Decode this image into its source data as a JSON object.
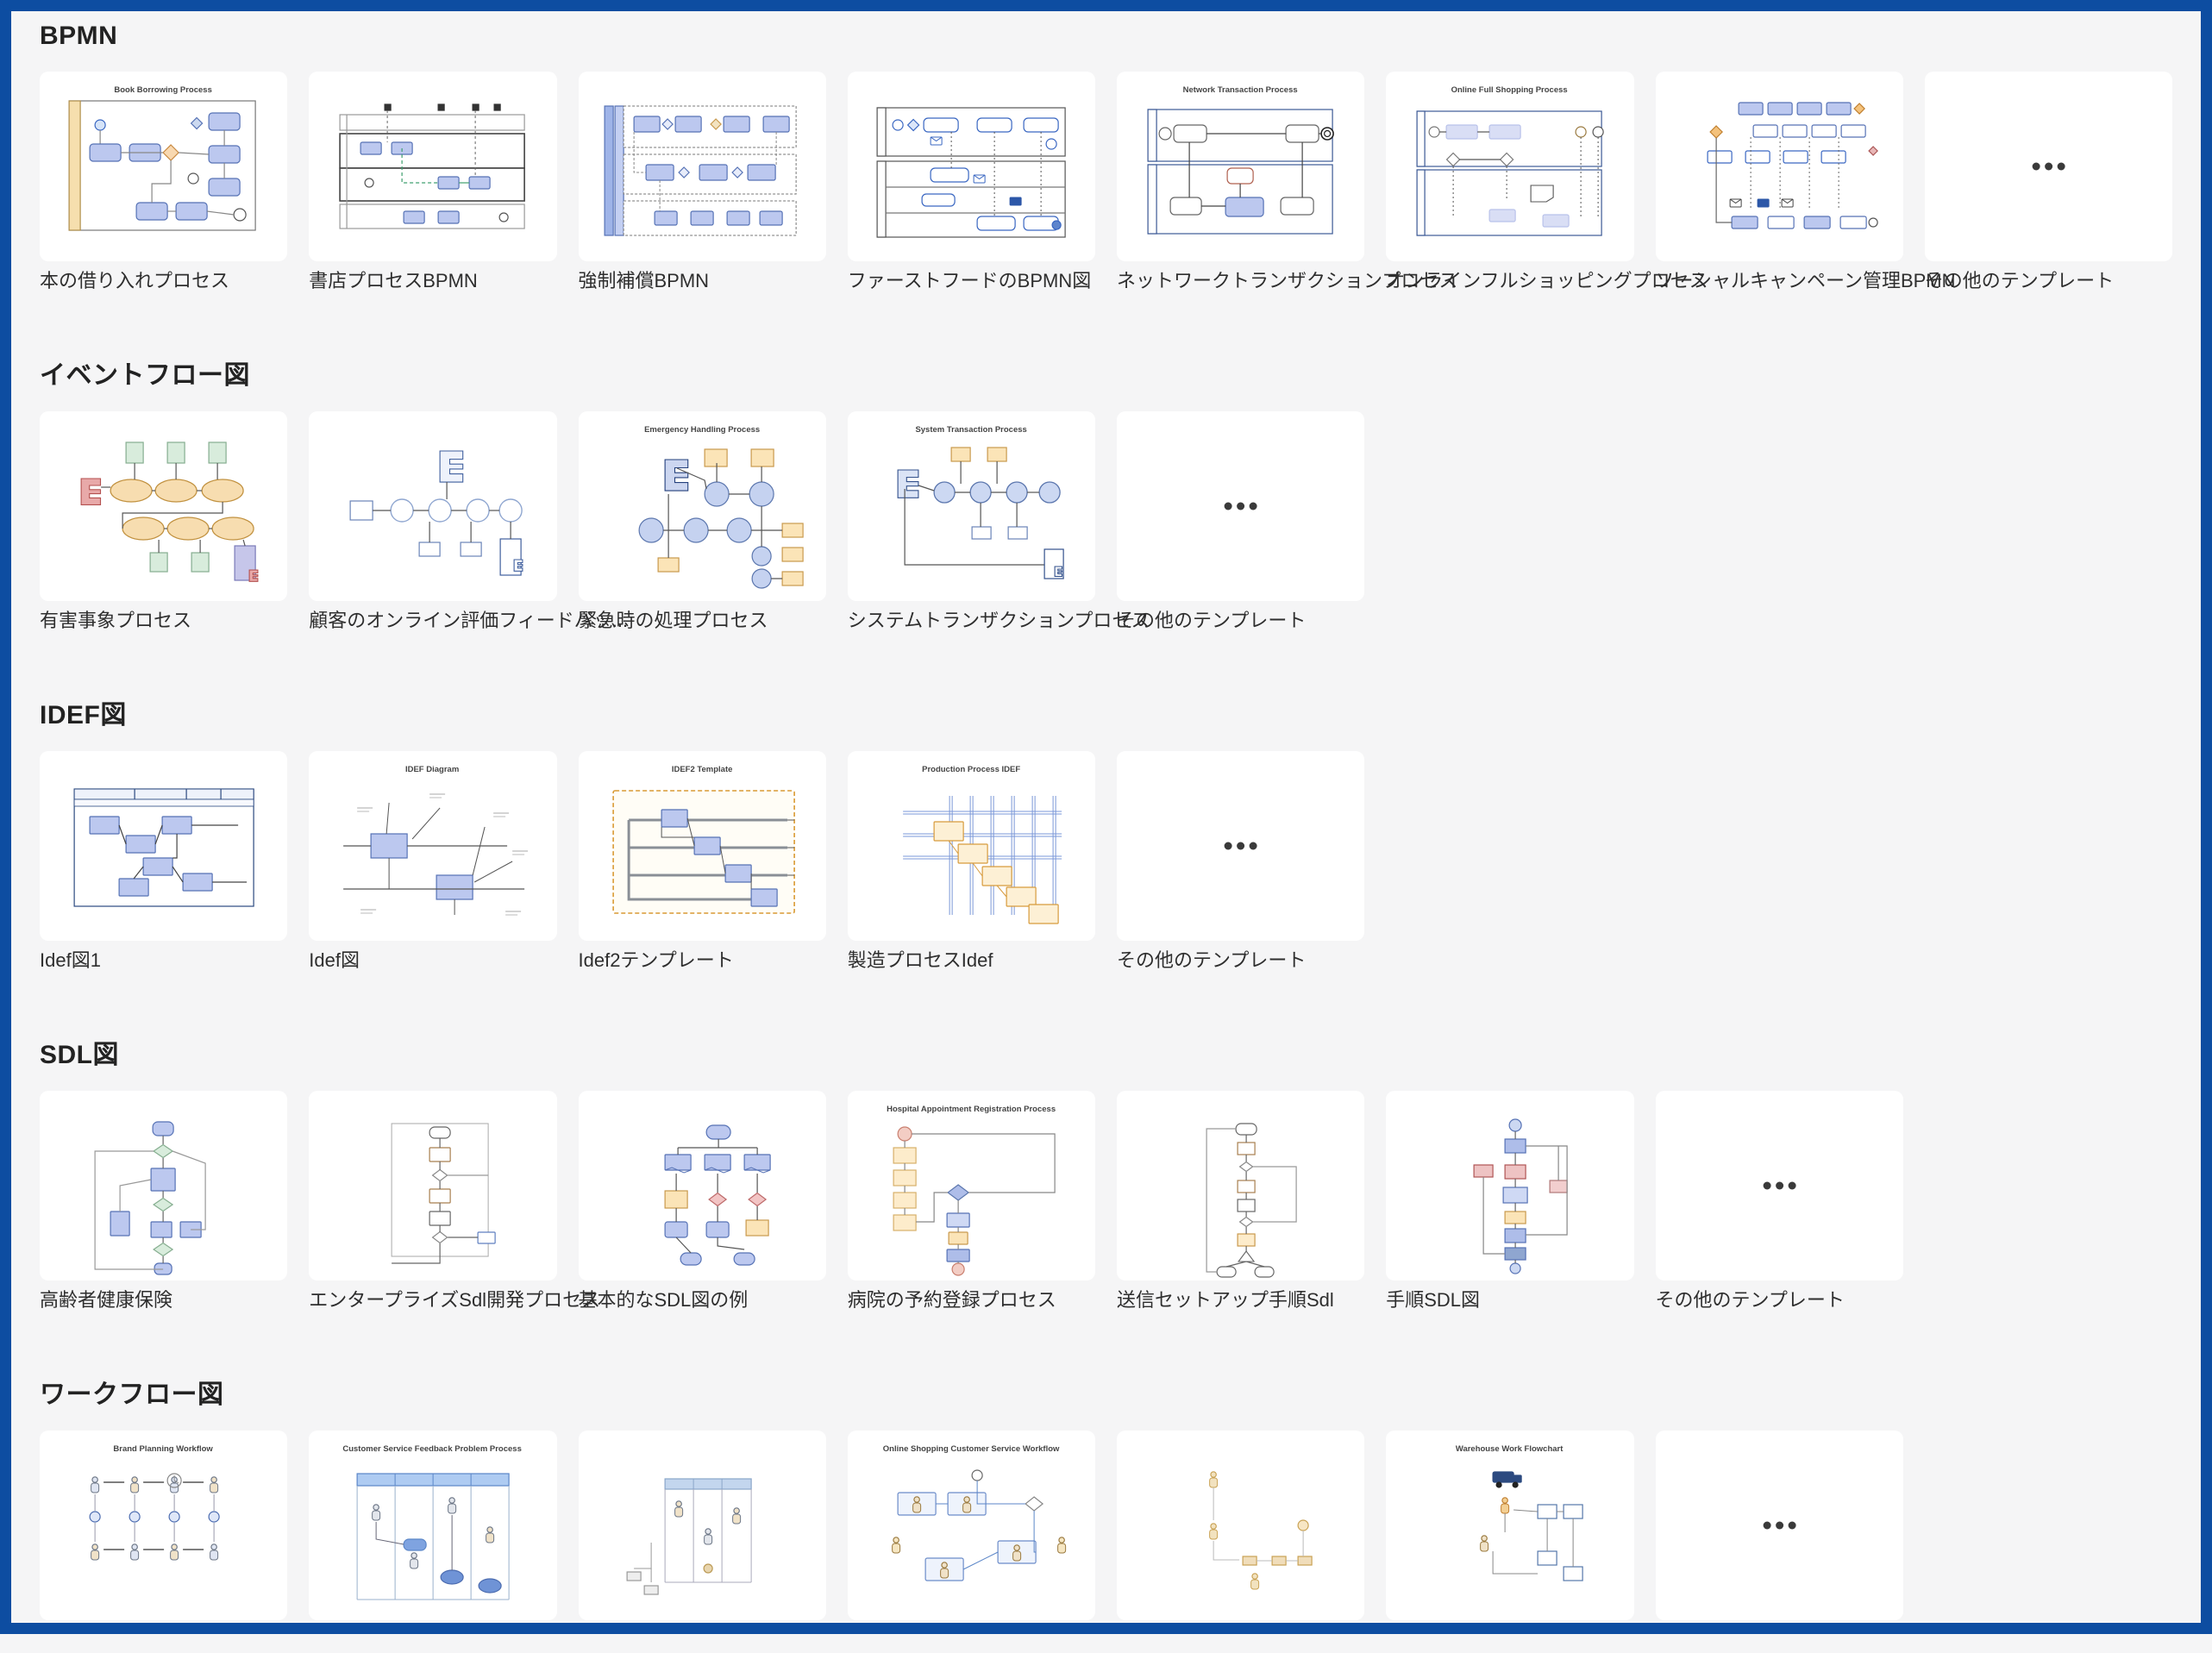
{
  "page": {
    "frame_color": "#0d4da1",
    "background_color": "#f5f5f6",
    "card_color": "#ffffff",
    "heading_color": "#222222",
    "label_color": "#2e2e2e",
    "ellipsis_color": "#3a3a3a"
  },
  "sections": [
    {
      "title": "BPMN",
      "cards": [
        {
          "label": "本の借り入れプロセス",
          "thumb_title": "Book Borrowing Process",
          "kind": "bpmn_library"
        },
        {
          "label": "書店プロセスBPMN",
          "kind": "bpmn_lanes_h"
        },
        {
          "label": "強制補償BPMN",
          "kind": "bpmn_lanes_blue"
        },
        {
          "label": "ファーストフードのBPMN図",
          "kind": "bpmn_pool"
        },
        {
          "label": "ネットワークトランザクションプロセス",
          "thumb_title": "Network Transaction Process",
          "kind": "bpmn_network"
        },
        {
          "label": "オンラインフルショッピングプロセス",
          "thumb_title": "Online Full Shopping Process",
          "kind": "bpmn_shopping"
        },
        {
          "label": "ソーシャルキャンペーン管理BPMN",
          "kind": "bpmn_social"
        },
        {
          "label": "その他のテンプレート",
          "kind": "more",
          "icon": "ellipsis-icon"
        }
      ]
    },
    {
      "title": "イベントフロー図",
      "cards": [
        {
          "label": "有害事象プロセス",
          "kind": "event_adverse"
        },
        {
          "label": "顧客のオンライン評価フィードバッ...",
          "kind": "event_feedback"
        },
        {
          "label": "緊急時の処理プロセス",
          "thumb_title": "Emergency Handling Process",
          "kind": "event_emergency"
        },
        {
          "label": "システムトランザクションプロセス",
          "thumb_title": "System Transaction Process",
          "kind": "event_system"
        },
        {
          "label": "その他のテンプレート",
          "kind": "more",
          "icon": "ellipsis-icon"
        }
      ]
    },
    {
      "title": "IDEF図",
      "cards": [
        {
          "label": "Idef図1",
          "kind": "idef1"
        },
        {
          "label": "Idef図",
          "thumb_title": "IDEF Diagram",
          "kind": "idef_diagram"
        },
        {
          "label": "Idef2テンプレート",
          "thumb_title": "IDEF2 Template",
          "kind": "idef2"
        },
        {
          "label": "製造プロセスIdef",
          "thumb_title": "Production Process IDEF",
          "kind": "idef_production"
        },
        {
          "label": "その他のテンプレート",
          "kind": "more",
          "icon": "ellipsis-icon"
        }
      ]
    },
    {
      "title": "SDL図",
      "cards": [
        {
          "label": "高齢者健康保険",
          "kind": "sdl_health"
        },
        {
          "label": "エンタープライズSdl開発プロセス",
          "kind": "sdl_enterprise"
        },
        {
          "label": "基本的なSDL図の例",
          "kind": "sdl_basic"
        },
        {
          "label": "病院の予約登録プロセス",
          "thumb_title": "Hospital Appointment Registration Process",
          "kind": "sdl_hospital"
        },
        {
          "label": "送信セットアップ手順Sdl",
          "kind": "sdl_send"
        },
        {
          "label": "手順SDL図",
          "kind": "sdl_procedure"
        },
        {
          "label": "その他のテンプレート",
          "kind": "more",
          "icon": "ellipsis-icon"
        }
      ]
    },
    {
      "title": "ワークフロー図",
      "cards": [
        {
          "label": "",
          "thumb_title": "Brand Planning Workflow",
          "kind": "wf_brand"
        },
        {
          "label": "",
          "thumb_title": "Customer Service Feedback Problem Process",
          "kind": "wf_customer"
        },
        {
          "label": "",
          "kind": "wf_hotel"
        },
        {
          "label": "",
          "thumb_title": "Online Shopping Customer Service Workflow",
          "kind": "wf_online"
        },
        {
          "label": "",
          "kind": "wf_escalation"
        },
        {
          "label": "",
          "thumb_title": "Warehouse Work Flowchart",
          "kind": "wf_warehouse"
        },
        {
          "label": "",
          "kind": "more",
          "icon": "ellipsis-icon"
        }
      ]
    }
  ]
}
